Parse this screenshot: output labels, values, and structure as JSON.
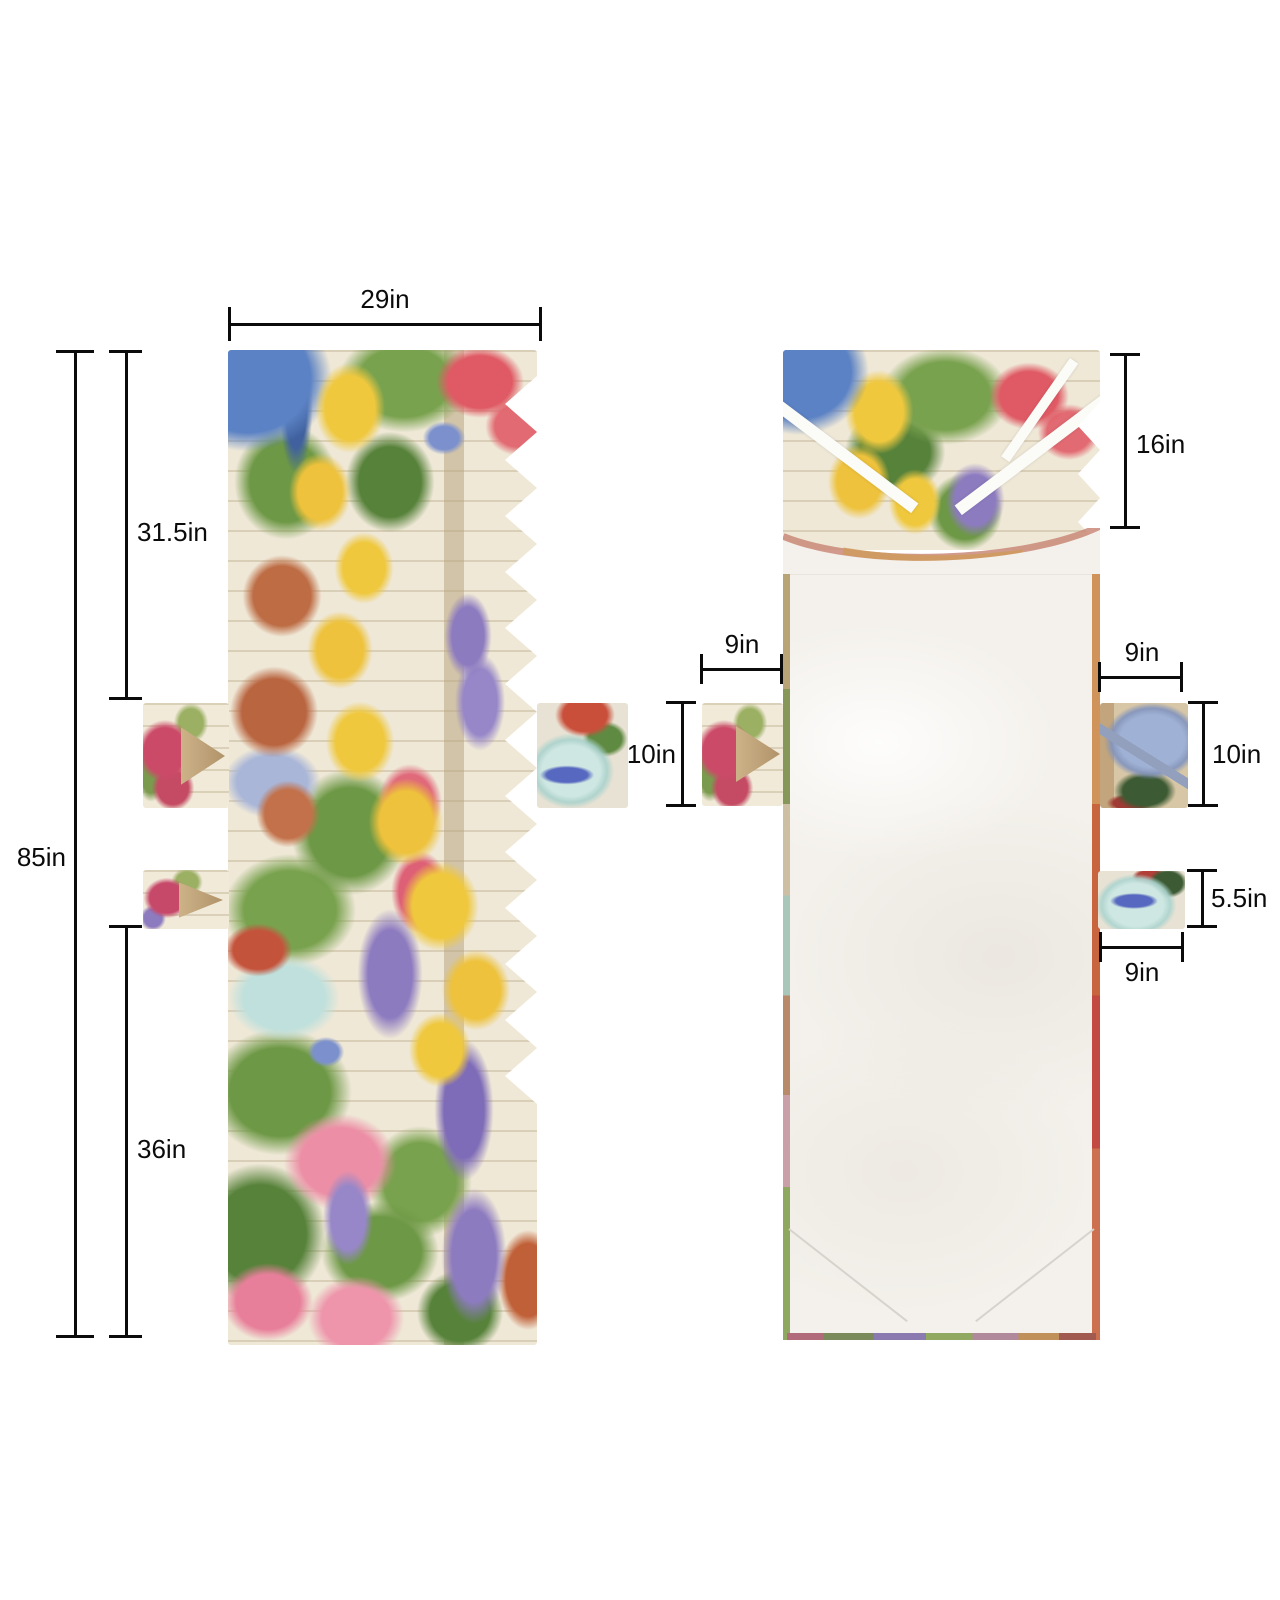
{
  "dims": {
    "front_width": "29in",
    "front_total_height": "85in",
    "front_upper_height": "31.5in",
    "front_lower_height": "36in",
    "back_top_height": "16in",
    "back_left_pocket_width": "9in",
    "back_left_pocket_height": "10in",
    "back_right_pocket_width": "9in",
    "back_right_pocket_height": "10in",
    "back_small_pocket_height": "5.5in",
    "back_small_pocket_width": "9in"
  },
  "palette": {
    "dimension_line": "#0b0b0b",
    "page_background": "#ffffff",
    "fabric_white": "#f4f1ec",
    "fence_cream": "#efe8d7",
    "bucket_blue": "#5b82c4",
    "flower_yellow": "#efc83e",
    "flower_red": "#df5a64",
    "flower_pink": "#ec8fa6",
    "flower_purple": "#8d7bc0",
    "leaf_green": "#6d9845",
    "terracotta": "#bd6c44",
    "hat_teal": "#bfe0dc"
  }
}
